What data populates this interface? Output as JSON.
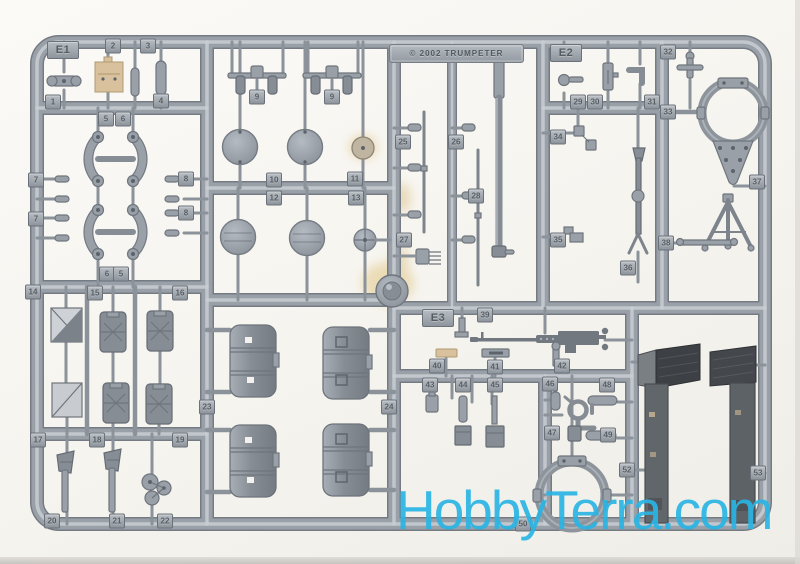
{
  "watermark": {
    "text": "HobbyTerra.com",
    "color": "#2ab5e4"
  },
  "plaque": {
    "text": "© 2002 TRUMPETER"
  },
  "colors": {
    "plastic_mid": "#99a0a8",
    "plastic_dark": "#757b83",
    "plastic_light": "#c9ced4",
    "dark_parts": "#575b60",
    "tan_parts": "#d8c19c",
    "background": "#f7f5f0"
  },
  "section_tags": [
    {
      "label": "E1",
      "x": 63,
      "y": 50
    },
    {
      "label": "E2",
      "x": 566,
      "y": 53
    },
    {
      "label": "E3",
      "x": 438,
      "y": 318
    }
  ],
  "part_tags": [
    {
      "label": "2",
      "x": 113,
      "y": 46
    },
    {
      "label": "3",
      "x": 148,
      "y": 46
    },
    {
      "label": "1",
      "x": 53,
      "y": 102
    },
    {
      "label": "4",
      "x": 161,
      "y": 101
    },
    {
      "label": "5",
      "x": 106,
      "y": 119
    },
    {
      "label": "6",
      "x": 123,
      "y": 119
    },
    {
      "label": "9",
      "x": 257,
      "y": 97
    },
    {
      "label": "9",
      "x": 332,
      "y": 97
    },
    {
      "label": "7",
      "x": 36,
      "y": 180
    },
    {
      "label": "7",
      "x": 36,
      "y": 219
    },
    {
      "label": "8",
      "x": 186,
      "y": 179
    },
    {
      "label": "8",
      "x": 186,
      "y": 213
    },
    {
      "label": "10",
      "x": 274,
      "y": 180
    },
    {
      "label": "11",
      "x": 355,
      "y": 179
    },
    {
      "label": "12",
      "x": 274,
      "y": 198
    },
    {
      "label": "13",
      "x": 356,
      "y": 198
    },
    {
      "label": "6",
      "x": 107,
      "y": 274
    },
    {
      "label": "5",
      "x": 121,
      "y": 274
    },
    {
      "label": "25",
      "x": 403,
      "y": 142
    },
    {
      "label": "26",
      "x": 456,
      "y": 142
    },
    {
      "label": "28",
      "x": 476,
      "y": 196
    },
    {
      "label": "27",
      "x": 404,
      "y": 240
    },
    {
      "label": "29",
      "x": 578,
      "y": 102
    },
    {
      "label": "30",
      "x": 595,
      "y": 102
    },
    {
      "label": "31",
      "x": 652,
      "y": 102
    },
    {
      "label": "32",
      "x": 668,
      "y": 52
    },
    {
      "label": "33",
      "x": 668,
      "y": 112
    },
    {
      "label": "34",
      "x": 558,
      "y": 137
    },
    {
      "label": "35",
      "x": 558,
      "y": 240
    },
    {
      "label": "36",
      "x": 628,
      "y": 268
    },
    {
      "label": "37",
      "x": 757,
      "y": 182
    },
    {
      "label": "38",
      "x": 666,
      "y": 243
    },
    {
      "label": "14",
      "x": 33,
      "y": 292
    },
    {
      "label": "15",
      "x": 95,
      "y": 293
    },
    {
      "label": "16",
      "x": 180,
      "y": 293
    },
    {
      "label": "23",
      "x": 207,
      "y": 407
    },
    {
      "label": "24",
      "x": 389,
      "y": 407
    },
    {
      "label": "17",
      "x": 38,
      "y": 440
    },
    {
      "label": "18",
      "x": 97,
      "y": 440
    },
    {
      "label": "19",
      "x": 180,
      "y": 440
    },
    {
      "label": "20",
      "x": 52,
      "y": 521
    },
    {
      "label": "21",
      "x": 117,
      "y": 521
    },
    {
      "label": "22",
      "x": 165,
      "y": 521
    },
    {
      "label": "39",
      "x": 485,
      "y": 315
    },
    {
      "label": "40",
      "x": 437,
      "y": 366
    },
    {
      "label": "41",
      "x": 495,
      "y": 367
    },
    {
      "label": "42",
      "x": 562,
      "y": 366
    },
    {
      "label": "43",
      "x": 430,
      "y": 385
    },
    {
      "label": "44",
      "x": 463,
      "y": 385
    },
    {
      "label": "45",
      "x": 495,
      "y": 385
    },
    {
      "label": "46",
      "x": 550,
      "y": 384
    },
    {
      "label": "48",
      "x": 607,
      "y": 385
    },
    {
      "label": "47",
      "x": 552,
      "y": 433
    },
    {
      "label": "49",
      "x": 608,
      "y": 435
    },
    {
      "label": "50",
      "x": 523,
      "y": 524
    },
    {
      "label": "52",
      "x": 627,
      "y": 470
    },
    {
      "label": "53",
      "x": 758,
      "y": 473
    }
  ]
}
